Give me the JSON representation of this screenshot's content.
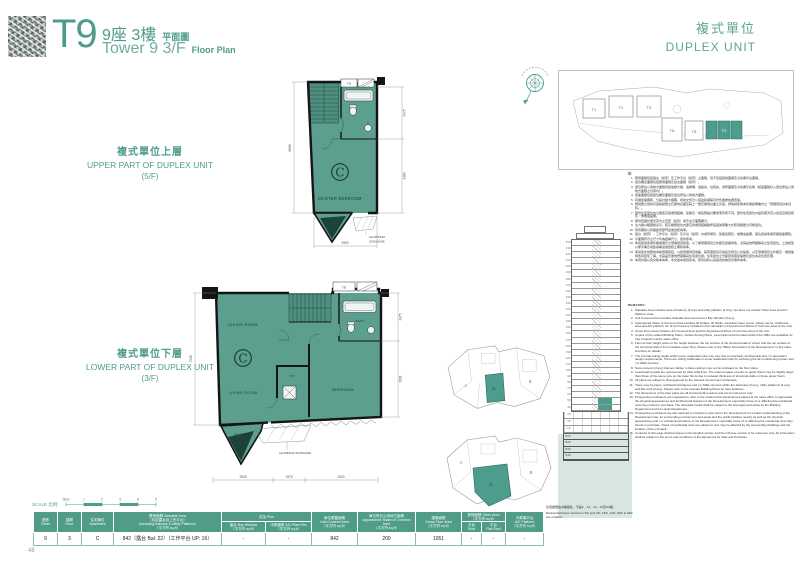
{
  "colors": {
    "accent": "#4E9C8D",
    "plan_fill": "#5C9F8E",
    "wall": "#151515",
    "table_header": "#4F9C89",
    "section_ground": "#D7E6DF"
  },
  "page": {
    "number": "48"
  },
  "header": {
    "logo": "T9",
    "title_zh": "9座  3樓",
    "title_zh_small": "平面圖",
    "title_en": "Tower 9  3/F",
    "title_en_small": "Floor Plan",
    "duplex_zh": "複式單位",
    "duplex_en": "DUPLEX UNIT"
  },
  "section_labels": {
    "upper_zh": "複式單位上層",
    "upper_en": "UPPER PART OF DUPLEX UNIT",
    "upper_floor": "(5/F)",
    "lower_zh": "複式單位下層",
    "lower_en": "LOWER PART OF DUPLEX UNIT",
    "lower_floor": "(3/F)"
  },
  "plans": {
    "upper": {
      "unit_letter": "C",
      "rooms": {
        "master_bedroom": "MASTER BEDROOM"
      },
      "fixtures": {
        "td": "TD"
      },
      "sunshade_l1": "ALUMINIUM",
      "sunshade_l2": "SUNSHADE",
      "dims": {
        "left": "6668",
        "right_top": "2475",
        "right_bottom": "3383",
        "bottom": "3900"
      }
    },
    "lower": {
      "unit_letter": "C",
      "rooms": {
        "dining": "DINING ROOM",
        "living": "LIVING ROOM",
        "bedroom": "BEDROOM",
        "kitchen": "KIT.",
        "bath": "BATH",
        "balcony": "BALCONY"
      },
      "fixtures": {
        "td": "TD"
      },
      "sunshade": "ALUMINIUM SUNSHADE",
      "dims": {
        "left": "7948",
        "right_top": "2475",
        "right_bottom": "3381",
        "bottom_1": "2825",
        "bottom_2": "1575",
        "bottom_3": "3300"
      }
    }
  },
  "site_plan": {
    "towers": [
      "T1",
      "T2",
      "T3",
      "T6",
      "T8",
      "T9"
    ],
    "highlight": "T9"
  },
  "key_plans": {
    "unit_a": "A",
    "unit_b": "B",
    "unit_c": "C"
  },
  "tower_section": {
    "floors": [
      "35/F",
      "33/F",
      "32/F",
      "31/F",
      "30/F",
      "29/F",
      "28/F",
      "27/F",
      "26/F",
      "25/F",
      "23/F",
      "22/F",
      "21/F",
      "20/F",
      "19/F",
      "18/F",
      "17/F",
      "16/F",
      "15/F",
      "12/F",
      "11/F",
      "10/F",
      "9/F",
      "8/F",
      "7/F",
      "6/F",
      "5/F",
      "3/F"
    ],
    "podium": [
      "2/F",
      "1/F",
      "G/F"
    ],
    "basement": [
      "B1/F",
      "B2/F",
      "B3/F",
      "B4/F"
    ],
    "highlight_floors": [
      "5/F",
      "3/F"
    ]
  },
  "floor_note": {
    "zh": "住宅樓層由3樓開始，不設4、13、14、24及34樓。",
    "en": "Residential floors start from 3/F and 4/F, 13/F, 14/F, 24/F & 34/F are omitted."
  },
  "notes": {
    "title": "註：",
    "items": [
      "實用面積包括露台（如有）及工作平台（如有）之面積，但不包括其他面積及冷氣機平台面積。",
      "單位覆蓋面積包括實用面積及窗台面積（如有）。",
      "單位所佔公用地方面積包括電梯大堂、電梯槽、電錶房、垃圾房、會所面積及冷氣機平台等（如該面積計入單位所佔公用地方面積之計算內）。",
      "建築面積包括單位覆蓋面積及單位所佔公用地方面積。",
      "有關建築圖則、分區計劃大綱圖、批地文件及公契最新擬稿可於售樓處免費查閱。",
      "層與層之間的高度指該層之石屎地台面至其上一層石屎地台面之高度。詳情請參閱本售樓說明書內之「發展項目基本資料」。",
      "部份住宅單位內之樓底高度或因結構、建築及／或裝飾設計要求而有所不同。部份住宅單位內設有假天花以遮蓋空調系統及／或機電設備。",
      "部份隱藏於假天花內之百葉（如有）或不在平面圖顯示。",
      "主力牆以粗實線表示。較高樓層單位內部空間或因結構牆厚度遞減而略大於較低樓層之同類單位。",
      "所有圖則以有關政府部門最後批核為準。",
      "露台（如有）、工作平台（如有）及平台（如有）內或有喉管、建築裝飾及／或機電設備，其位置請參閱有關建築圖則。",
      "平面圖所示之尺寸均為結構尺寸，僅供參考。",
      "準買家請參閱售樓處展示之發展項目模型，以了解發展項目之外觀及建築特色，尤其是他們擬購買之住宅單位。上述模型以屋宇署及地政總署最後批核之圖則為準。",
      "準買家亦請實地考察發展項目，以對發展項目地盤、其周邊環境及地區及附近公共設施，以及發展項目之外觀及／或建築特色有較佳了解，尤其是影響他們擬購買住宅單位者。住宅單位之景觀受周邊建築物及單位本身位置影響。",
      "本頁內容以英文版本為準，中文版本僅供參考。所有資料以買賣合約條款及條件為準。"
    ]
  },
  "remarks": {
    "title": "REMARKS:",
    "items": [
      "Saleable Area includes area of balcony (if any) and utility platform (if any), but does not include Other Area and A/C Platform Area.",
      "Unit Covered Area includes Saleable Area and area of Bay Window (if any).",
      "Apportioned Share of Common Area includes lift lobbies, lift shafts, electrical meter rooms, refuse rooms, clubhouse area and A/C platform etc (if such area is included in the calculation of Apportioned Share of Common Area of the unit).",
      "Gross Floor Area includes Unit Covered Area and the Apportioned Share of Common Area of the unit.",
      "Copies of the related Building Plans, Outline Zoning Plans, Land Grant and the latest draft of the DMC are available for free inspection at the sales office.",
      "Floor-to-floor height refers to the height between the top surface of the structural slab of a floor and the top surface of the structural slab of its immediate upper floor. Please refer to the \"Basic Information of the Development\" in this sales brochure for details.",
      "The internal ceiling height within some residential units may vary due to structural, architectural and / or decoration design requirements. There are ceiling bulkheads in some residential units for enclosing the air-conditioning system and / or M&E services.",
      "Some louvers (if any) that are hidden in false ceilings may not be indicated on the floor plans.",
      "Load bearing walls are represented by thick solid lines. The internal space of units on upper floors may be slightly larger than those of the same type on the lower floors due to reduced thickness of structural walls on those upper floors.",
      "All plans are subject to final approval by the relevant Government Authorities.",
      "There may be pipes, architectural features and / or M&E services within the balconies (if any), utility platforms (if any) and flat roofs (if any). Please refer to the relevant Building Plans for their locations.",
      "The dimensions of the floor plans are all structural dimensions and are for reference only.",
      "Prospective purchasers are requested to refer to the model of the Development placed at the sales office to appreciate the physical appearances and architectural features of the Development, especially those of or affecting the residential units they intend to purchase. The aforesaid model shall be subject to the final approved plans by the Building Department and the Lands Department.",
      "Prospective purchasers are also advised to conduct on-site visit to the Development for a better understanding of the Development site, its surrounding environment and areas and the public facilities nearby as well as the physical appearances and / or architectural feature of the Development, especially those of or affecting the residential units they intend to purchase. Views of residential units are subject to and may be affected by the surrounding buildings and the location of the unit itself.",
      "Contents of this page shall be based on the English version and the Chinese version is for reference only. All information shall be subject to the terms and conditions of the Agreement for Sale and Purchase."
    ]
  },
  "scale_bar": {
    "label": "SCALE 比例",
    "marks": [
      "0(m)",
      "1",
      "2",
      "3",
      "4",
      "5"
    ]
  },
  "table": {
    "headers": {
      "tower": {
        "zh": "座數",
        "en": "Tower"
      },
      "floor": {
        "zh": "樓層",
        "en": "Floor"
      },
      "apartment": {
        "zh": "住宅單位",
        "en": "Apartment"
      },
      "saleable": {
        "zh": "實用面積 Saleable Area",
        "l2": "（包括露台及工作平台）",
        "l3": "(including Balcony & Utility Platform)",
        "unit": "（平方呎 sq.ft）"
      },
      "plus": {
        "zh": "另加 Plus"
      },
      "bay": {
        "zh": "窗台 Bay Window",
        "unit": "（平方呎 sq.ft）"
      },
      "ac_plant": {
        "zh": "冷氣機房 A/C Plant Rm",
        "unit": "（平方呎 sq.ft）"
      },
      "covered": {
        "zh": "單位覆蓋面積",
        "en": "Unit Covered Area",
        "unit": "（平方呎 sq.ft）"
      },
      "common": {
        "zh": "單位所佔公用地方面積",
        "en": "Apportioned Share of Common Area",
        "unit": "（平方呎 sq.ft）"
      },
      "gfa": {
        "zh": "建築面積",
        "en": "Gross Floor Area",
        "unit": "（平方呎 sq.ft）"
      },
      "other": {
        "zh": "其他面積 Other Area",
        "unit": "（平方呎 sq.ft）"
      },
      "roof": {
        "zh": "天台",
        "en": "Roof"
      },
      "flat_roof": {
        "zh": "平台",
        "en": "Flat Roof"
      },
      "ac_platform": {
        "zh": "冷氣機平台",
        "en": "A/C Platform",
        "unit": "（平方呎 sq.ft）"
      }
    },
    "row": [
      "9",
      "3",
      "C",
      "842（露台 Bal: 22）（工作平台 UP: 16）",
      "-",
      "-",
      "842",
      "209",
      "1051",
      "-",
      "-",
      "-"
    ]
  }
}
